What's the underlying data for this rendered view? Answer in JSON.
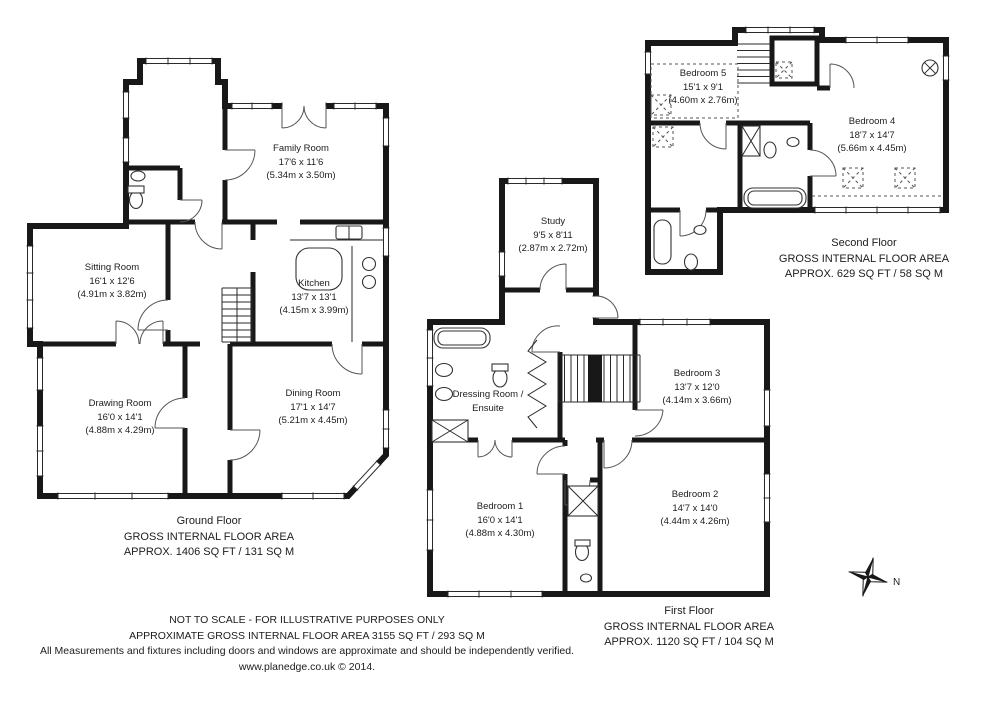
{
  "document": {
    "background": "#ffffff",
    "ink": "#1c1c1c"
  },
  "floors": [
    {
      "name": "Ground Floor",
      "area_label": "GROSS INTERNAL FLOOR AREA",
      "area_value": "APPROX. 1406 SQ FT / 131 SQ M",
      "rooms": [
        {
          "name": "Family Room",
          "imperial": "17'6 x 11'6",
          "metric": "(5.34m x 3.50m)"
        },
        {
          "name": "Sitting Room",
          "imperial": "16'1 x 12'6",
          "metric": "(4.91m x 3.82m)"
        },
        {
          "name": "Kitchen",
          "imperial": "13'7 x 13'1",
          "metric": "(4.15m x 3.99m)"
        },
        {
          "name": "Drawing Room",
          "imperial": "16'0 x 14'1",
          "metric": "(4.88m x 4.29m)"
        },
        {
          "name": "Dining Room",
          "imperial": "17'1 x 14'7",
          "metric": "(5.21m x 4.45m)"
        }
      ]
    },
    {
      "name": "First Floor",
      "area_label": "GROSS INTERNAL FLOOR AREA",
      "area_value": "APPROX. 1120 SQ FT / 104 SQ M",
      "rooms": [
        {
          "name": "Study",
          "imperial": "9'5 x 8'11",
          "metric": "(2.87m x 2.72m)"
        },
        {
          "name": "Dressing Room /",
          "name2": "Ensuite"
        },
        {
          "name": "Bedroom 1",
          "imperial": "16'0 x 14'1",
          "metric": "(4.88m x 4.30m)"
        },
        {
          "name": "Bedroom 2",
          "imperial": "14'7 x 14'0",
          "metric": "(4.44m x 4.26m)"
        },
        {
          "name": "Bedroom 3",
          "imperial": "13'7 x 12'0",
          "metric": "(4.14m x 3.66m)"
        }
      ]
    },
    {
      "name": "Second Floor",
      "area_label": "GROSS INTERNAL FLOOR AREA",
      "area_value": "APPROX. 629 SQ FT / 58 SQ M",
      "rooms": [
        {
          "name": "Bedroom 5",
          "imperial": "15'1 x 9'1",
          "metric": "(4.60m x 2.76m)"
        },
        {
          "name": "Bedroom 4",
          "imperial": "18'7 x 14'7",
          "metric": "(5.66m x 4.45m)"
        }
      ]
    }
  ],
  "disclaimer": {
    "line1": "NOT TO SCALE - FOR ILLUSTRATIVE PURPOSES ONLY",
    "line2": "APPROXIMATE GROSS INTERNAL FLOOR AREA 3155 SQ FT / 293 SQ M",
    "line3": "All Measurements and fixtures including doors and windows are approximate and should be independently verified.",
    "line4": "www.planedge.co.uk  © 2014."
  },
  "compass": {
    "label": "N"
  }
}
